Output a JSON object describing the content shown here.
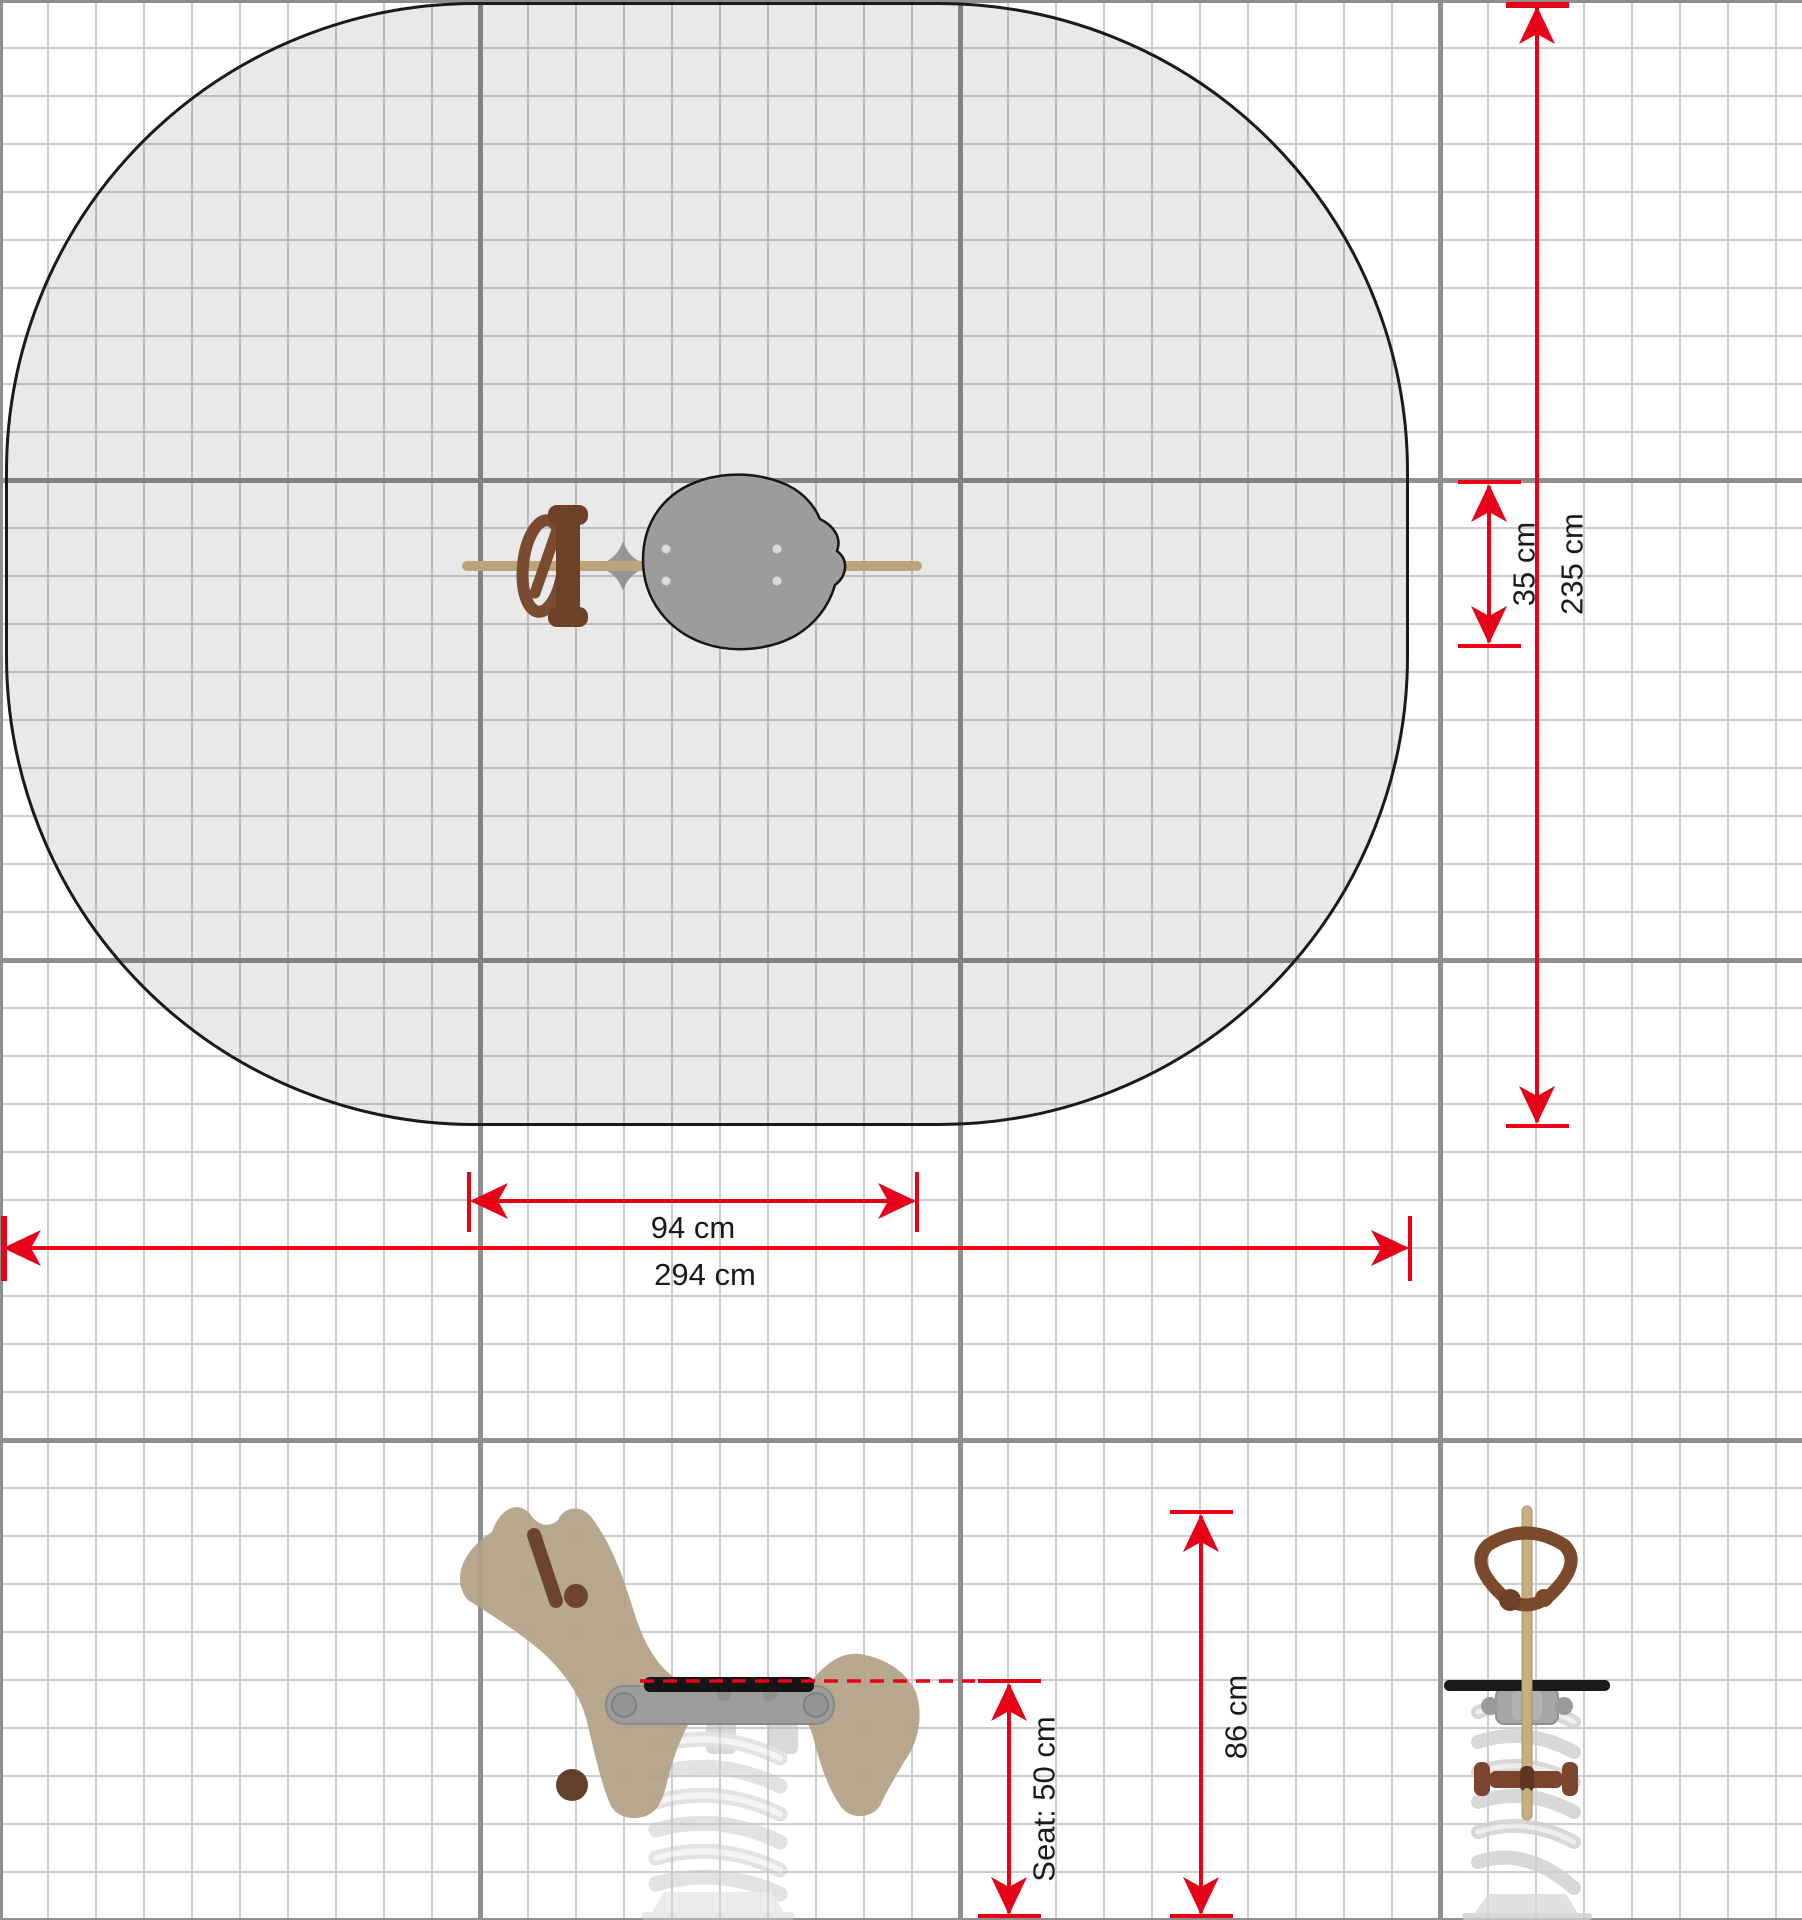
{
  "drawing": {
    "subject": "spring-rocker-safety-zone-plan",
    "dimensions": {
      "footprint_width": {
        "label": "94 cm"
      },
      "zone_width": {
        "label": "294 cm"
      },
      "side_offset": {
        "label": "35 cm"
      },
      "zone_height": {
        "label": "235 cm"
      },
      "seat_height": {
        "label": "Seat: 50 cm"
      },
      "total_height": {
        "label": "86 cm"
      }
    },
    "colors": {
      "dimension_red": "#e60018",
      "zone_fill": "#e9e9e9",
      "zone_outline": "#1a1a1a",
      "grid_minor": "#cdcdcd",
      "grid_major": "#8f8f8f",
      "wood_tan": "#b2a187",
      "beam_tan": "#bba47c",
      "dark_brown": "#6d4128",
      "metal_gray": "#9c9c9c",
      "seat_black": "#151515"
    }
  }
}
